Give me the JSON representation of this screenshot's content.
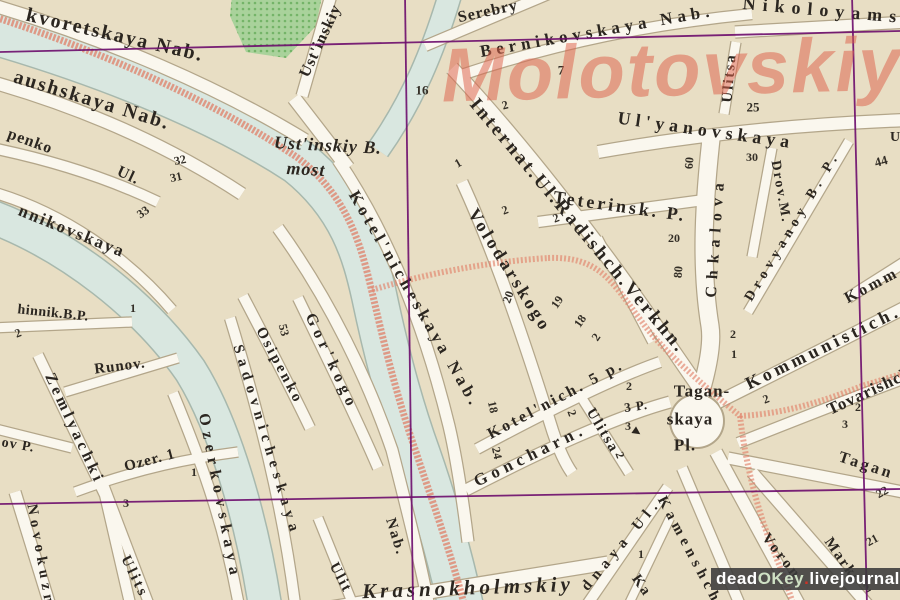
{
  "watermarks": {
    "district": "Molotovskiy",
    "credit_dead": "dead",
    "credit_okey": "OKey",
    "credit_dot1": ".",
    "credit_livejournal": "livejournal",
    "credit_dot2": ".",
    "credit_com": "com"
  },
  "labels": {
    "kvoretskaya": "kvoretskaya Nab.",
    "raushskaya": "aushskaya Nab.",
    "penko": "penko",
    "penko_ul": "Ul.",
    "nnikovskaya": "nnikovskaya",
    "hinnik": "hinnik.B.P.",
    "runov": "Runov.",
    "zemlyachki": "Zemlyachki",
    "ov_p": "ov P.",
    "ozer": "Ozer. 1",
    "novokuz": "Novokuzn",
    "ulits_sw": "Ulits",
    "ozerkovskaya": "Ozerkovskaya",
    "sadovnicheskaya": "Sadovnicheskaya",
    "osipenko": "Osipenko",
    "gorkogo": "Gor'kogo",
    "ustinskiy_vert": "Ust'inskiy",
    "most_line1": "Ust'inskiy B.",
    "most_line2": "most",
    "serebry": "Serebry",
    "bernikovskaya": "Bernikovskaya Nab.",
    "nikoloyams": "Nikoloyams",
    "internat": "Internat.Ul.Radishch.Verkhn.",
    "volodarskogo": "Volodarskogo",
    "teterinsk": "Teterinsk. P.",
    "ulyanovskaya": "Ul'yanovskaya",
    "ulitsa_ne": "Ulitsa",
    "chkalova": "Chkalova",
    "drov_m": "Drov.M.",
    "drovyanoy": "Drovyanoy B. P.",
    "kotelnicheskaya": "Kotel'nicheskaya Nab.",
    "kommunistich": "Kommunistich.",
    "komm_partial": "Komm",
    "tovarishch": "Tovarishch",
    "tagan1": "Tagan-",
    "tagan2": "skaya",
    "tagan3": "Pl.",
    "kotelnich5p": "Kotel'nich. 5 p.",
    "goncharn": "Goncharn.",
    "ulitsa_c": "Ulitsa",
    "nab_vert": "Nab.",
    "ulit_c": "Ulit",
    "krasnokholmskiy": "Krasnokholmskiy",
    "dnaya_ul": "dnaya Ul.",
    "kamensh": "Kamenshch",
    "ka": "Ka",
    "voron": "Voron",
    "marks": "Marks",
    "tagan_se": "Tagan",
    "p3": "3 P.",
    "u_edge": "U"
  },
  "numbers": {
    "n16": "16",
    "n2a": "2",
    "n7": "7",
    "n25": "25",
    "n30": "30",
    "n60": "60",
    "n20a": "20",
    "n80": "80",
    "n44": "44",
    "n32": "32",
    "n31": "31",
    "n33": "33",
    "n1a": "1",
    "n2b": "2",
    "n53": "53",
    "n2c": "2",
    "n2d": "2",
    "n1b": "1",
    "n20b": "20",
    "n19": "19",
    "n18a": "18",
    "n2e": "2",
    "n2f": "2",
    "n1c": "1",
    "n2g": "2",
    "n3a": "3",
    "n2h": "2",
    "n18b": "18",
    "n24": "24",
    "n2i": "2",
    "n2j": "2",
    "n3b": "3",
    "n2k": "2",
    "n1d": "1",
    "n1e": "1",
    "n3c": "3",
    "n22": "22",
    "n21": "21",
    "n2l": "2"
  },
  "colors": {
    "paper": "#e8dec4",
    "street_fill": "#faf7ee",
    "street_casing": "#b3a68a",
    "water_fill": "#d9e7e0",
    "water_edge": "#a7b8ad",
    "park": "#a9d29b",
    "park_dot": "#74b468",
    "grid": "#6d0d6d",
    "route_red": "#e0755c",
    "boundary_red": "#e2836c",
    "label_ink": "#2b2620",
    "watermark_red": "#dd614a",
    "credit_bg": "#3a3a3a",
    "credit_red": "#cc3327",
    "credit_green": "#cfe0c4"
  }
}
